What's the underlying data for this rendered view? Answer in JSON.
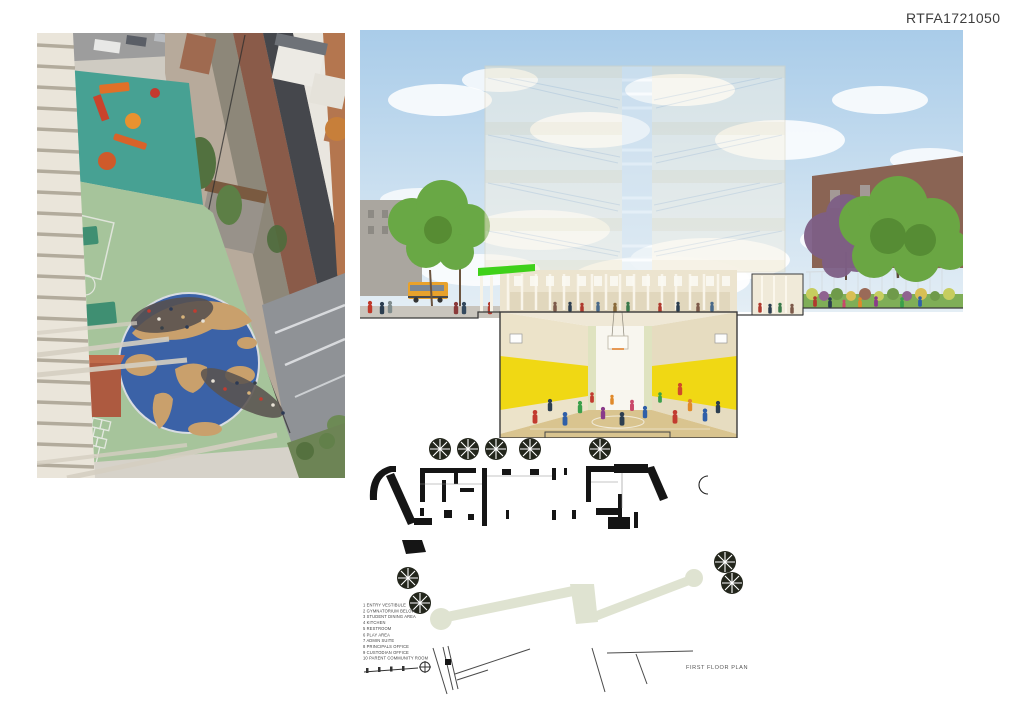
{
  "board": {
    "id": "RTFA1721050"
  },
  "plan": {
    "title": "FIRST FLOOR PLAN",
    "legend": [
      "1 ENTRY VESTIBULE",
      "2 GYMNATORIUM BELOW",
      "3 STUDENT DINING AREA",
      "4 KITCHEN",
      "5 RESTROOM",
      "6 PLAY AREA",
      "7 ADMIN SUITE",
      "8 PRINCIPALS OFFICE",
      "9 CUSTODIAN OFFICE",
      "10 PARENT COMMUNITY ROOM"
    ]
  },
  "colors": {
    "page-bg": "#ffffff",
    "board-id-color": "#3d3d3d",
    "gym-yellow": "#f0d814",
    "awning-green": "#3fd119",
    "plan-path": "#dfe3d1",
    "worldmap-blue": "#3b62a7",
    "worldmap-land": "#c9a06c",
    "playground-green": "#a6c49b",
    "playground-teal": "#47a193"
  }
}
